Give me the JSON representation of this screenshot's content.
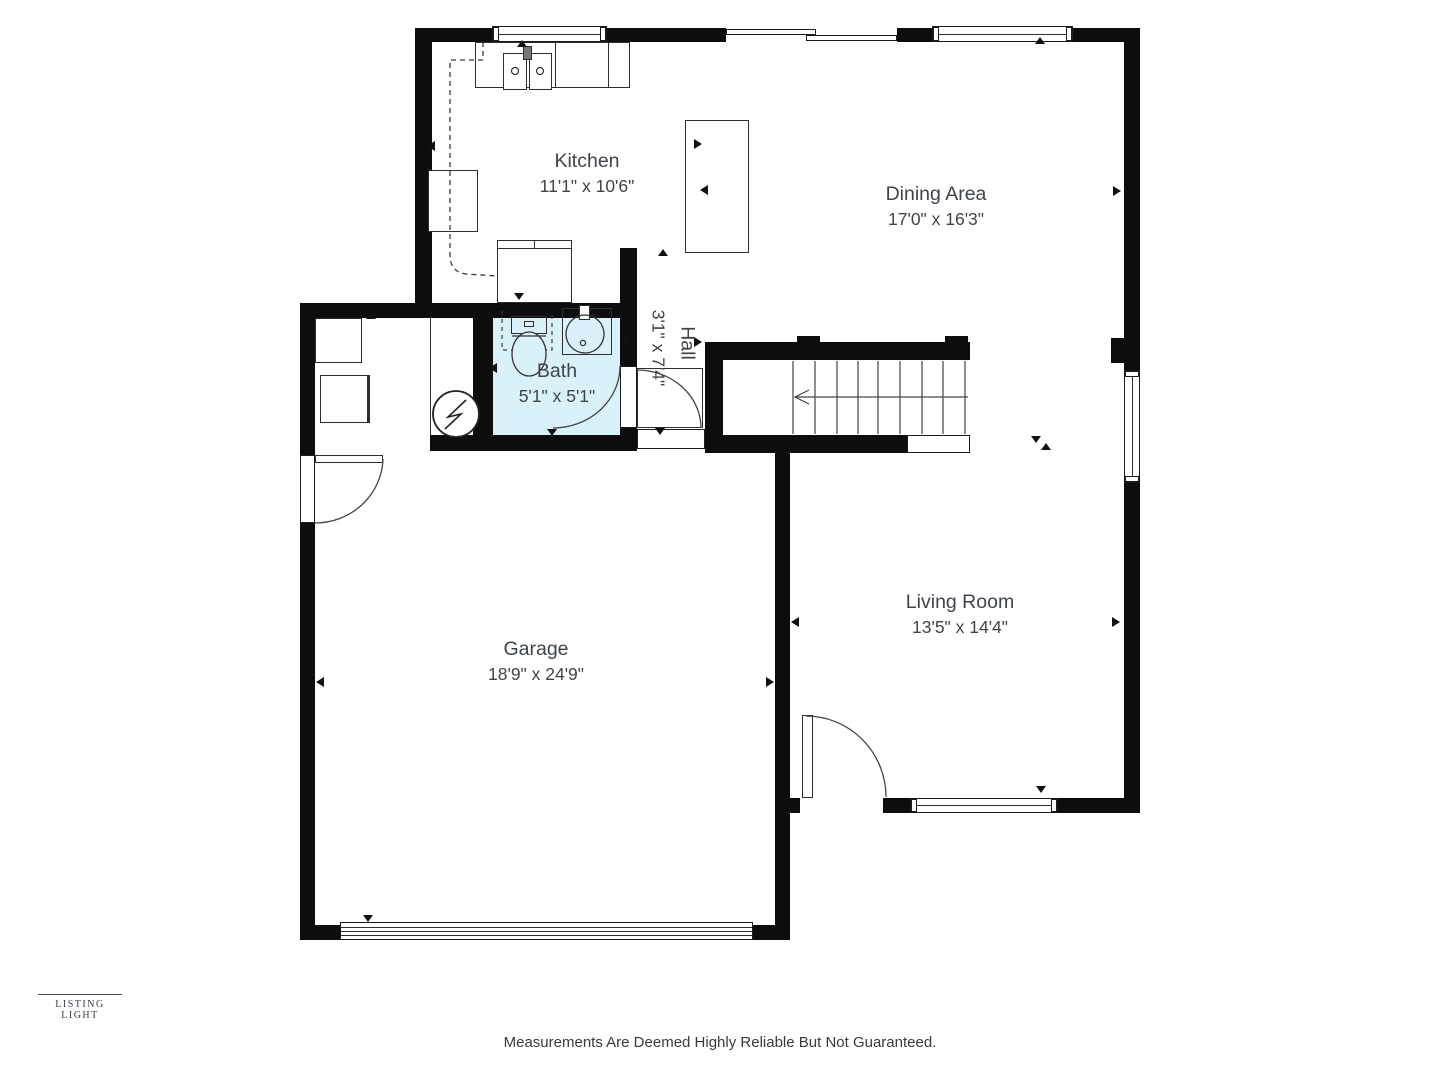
{
  "rooms": {
    "kitchen": {
      "name": "Kitchen",
      "dims": "11'1\" x 10'6\""
    },
    "dining": {
      "name": "Dining Area",
      "dims": "17'0\" x 16'3\""
    },
    "bath": {
      "name": "Bath",
      "dims": "5'1\" x 5'1\""
    },
    "hall": {
      "name": "Hall",
      "dims": "3'1\" x 7'4\""
    },
    "garage": {
      "name": "Garage",
      "dims": "18'9\" x 24'9\""
    },
    "living": {
      "name": "Living Room",
      "dims": "13'5\" x 14'4\""
    }
  },
  "branding": {
    "logo_text": "LISTING LIGHT"
  },
  "footer": {
    "disclaimer": "Measurements Are Deemed Highly Reliable But Not Guaranteed."
  },
  "colors": {
    "wall": "#0d0d0d",
    "bath_fill": "#d9f1f8",
    "label_text": "#3f444a"
  }
}
